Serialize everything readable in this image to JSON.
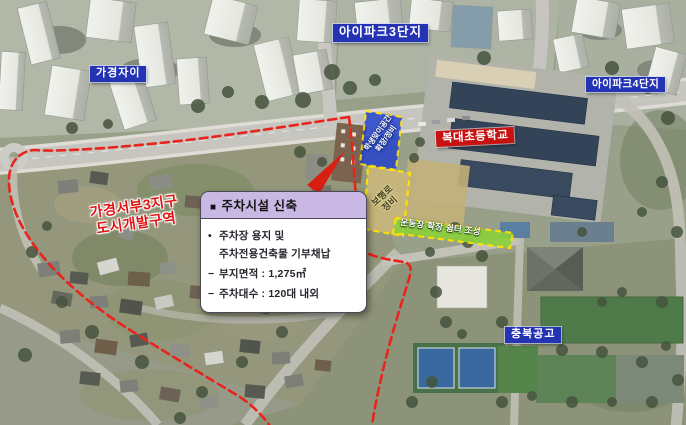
{
  "map_labels": {
    "gagyeong_jai": "가경자이",
    "ipark3": "아이파크3단지",
    "ipark4": "아이파크4단지",
    "bokdae_elementary": "복대초등학교",
    "chungbuk_technical": "충북공고",
    "dev_zone_line1": "가경서부3지구",
    "dev_zone_line2": "도시개발구역"
  },
  "site_overlays": {
    "student_zone_line1": "학생맞이공간",
    "student_zone_line2": "확장/정비",
    "walkway_line1": "보행로",
    "walkway_line2": "정비",
    "playground_label": "운동장 확장 쉼터 조성"
  },
  "info_box": {
    "title_bullet": "■",
    "title": "주차시설 신축",
    "lines": [
      {
        "marker": "•",
        "text": "주차장 용지 및"
      },
      {
        "marker": "",
        "text": "주차전용건축물 기부채납"
      },
      {
        "marker": "−",
        "text": "부지면적 : 1,275㎡"
      },
      {
        "marker": "−",
        "text": "주차대수 : 120대 내외"
      }
    ]
  },
  "colors": {
    "boundary_red": "#e8241c",
    "place_label_blue_bg": "#2433b4",
    "school_label_red_bg": "#c81212",
    "dev_zone_text_red": "#e01212",
    "overlay_dash_yellow": "#ffe400",
    "student_zone_blue_fill": "#1e3cd0",
    "playground_tan_fill": "#c8b67c",
    "green_strip_fill": "#8bd03e",
    "infobox_header_purple": "#c9b8e4",
    "infobox_body_white": "#ffffff"
  }
}
